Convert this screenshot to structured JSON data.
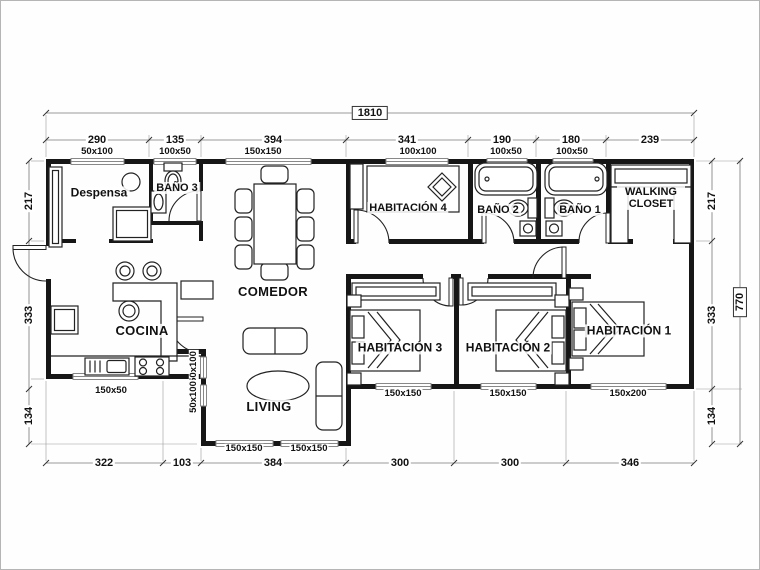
{
  "plan": {
    "overall": {
      "width": "1810",
      "height": "770"
    },
    "rooms": {
      "despensa": "Despensa",
      "bano3": "BAÑO 3",
      "comedor": "COMEDOR",
      "habitacion4": "HABITACIÓN 4",
      "bano2": "BAÑO 2",
      "bano1": "BAÑO 1",
      "walking_closet": "WALKING CLOSET",
      "cocina": "COCINA",
      "living": "LIVING",
      "habitacion3": "HABITACIÓN 3",
      "habitacion2": "HABITACIÓN 2",
      "habitacion1": "HABITACIÓN 1"
    },
    "dims_top": [
      "290",
      "135",
      "394",
      "341",
      "190",
      "180",
      "239"
    ],
    "dims_bottom": [
      "322",
      "103",
      "384",
      "300",
      "300",
      "346"
    ],
    "dims_left": [
      "217",
      "333",
      "134"
    ],
    "dims_right": [
      "217",
      "333",
      "134"
    ],
    "windows_top": [
      "50x100",
      "100x50",
      "150x150",
      "100x100",
      "100x50",
      "100x50"
    ],
    "windows_bottom": [
      "150x50",
      "150x150",
      "150x150",
      "150x150",
      "150x150",
      "150x200"
    ],
    "windows_side": [
      "50x100",
      "50x100"
    ],
    "colors": {
      "wall": "#161616",
      "dim_line": "#666666",
      "background": "#fefefe"
    }
  }
}
